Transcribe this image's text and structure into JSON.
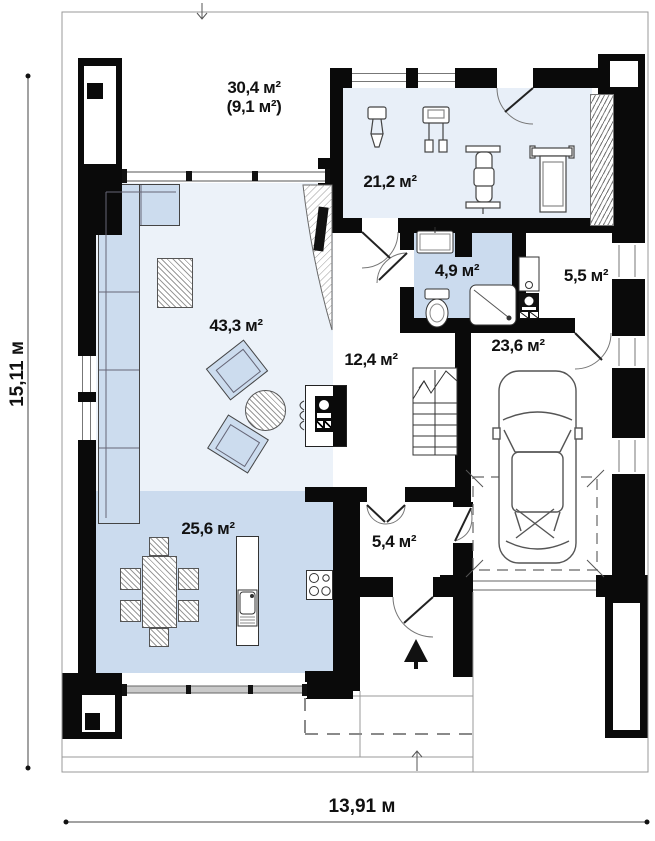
{
  "rooms": {
    "terrace": {
      "area": "30,4 м²",
      "secondary": "(9,1 м²)"
    },
    "gym": {
      "area": "21,2 м²"
    },
    "living": {
      "area": "43,3 м²"
    },
    "hall": {
      "area": "12,4 м²"
    },
    "bathroom": {
      "area": "4,9 м²"
    },
    "utility": {
      "area": "5,5 м²"
    },
    "garage": {
      "area": "23,6 м²"
    },
    "dining": {
      "area": "25,6 м²"
    },
    "entry": {
      "area": "5,4 м²"
    }
  },
  "dims": {
    "height_label": "15,11 м",
    "width_label": "13,91 м"
  },
  "colors": {
    "wall": "#0a0a0a",
    "room_light": "#ecf2f9",
    "room_gym": "#e8eff8",
    "room_medium": "#cbdbee",
    "furniture": "#ccdcee"
  }
}
